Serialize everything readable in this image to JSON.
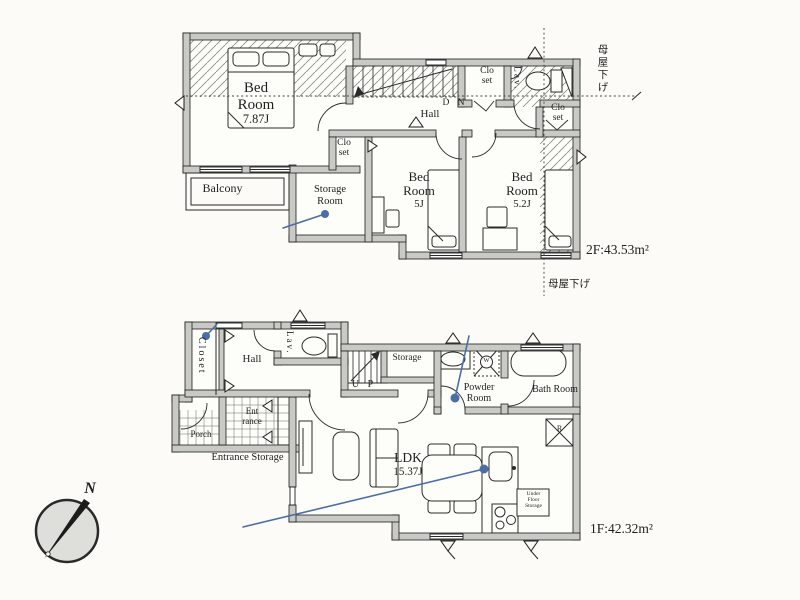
{
  "colors": {
    "annotation": "#4a6fa5",
    "wall_fill": "#c9c9c5",
    "line": "#1c1c1a"
  },
  "floor2": {
    "area": "2F:43.53m²",
    "roof_note_right": "母屋下げ",
    "roof_note_bottom": "母屋下げ",
    "bedroom_main": {
      "name": "Bed Room",
      "size": "7.87J"
    },
    "bedroom_5": {
      "name": "Bed Room",
      "size": "5J"
    },
    "bedroom_52": {
      "name": "Bed Room",
      "size": "5.2J"
    },
    "balcony": "Balcony",
    "storage_room": "Storage Room",
    "closet_small": "Clo set",
    "closet_top": "Clo set",
    "closet_right": "Clo set",
    "lav": "Lav.",
    "hall": "Hall",
    "stairs_dir": "D N"
  },
  "floor1": {
    "area": "1F:42.32m²",
    "closet": "Closet",
    "hall": "Hall",
    "lav": "Lav.",
    "stairs_dir": "U P",
    "storage": "Storage",
    "powder_room": "Powder Room",
    "bath_room": "Bath Room",
    "entrance": "Ent rance",
    "porch": "Porch",
    "entrance_storage": "Entrance Storage",
    "ldk": {
      "name": "LDK",
      "size": "15.37J"
    },
    "under_floor_storage": "Under Floor Storage",
    "washer": "W",
    "refrigerator": "R"
  },
  "compass": {
    "north": "N"
  }
}
